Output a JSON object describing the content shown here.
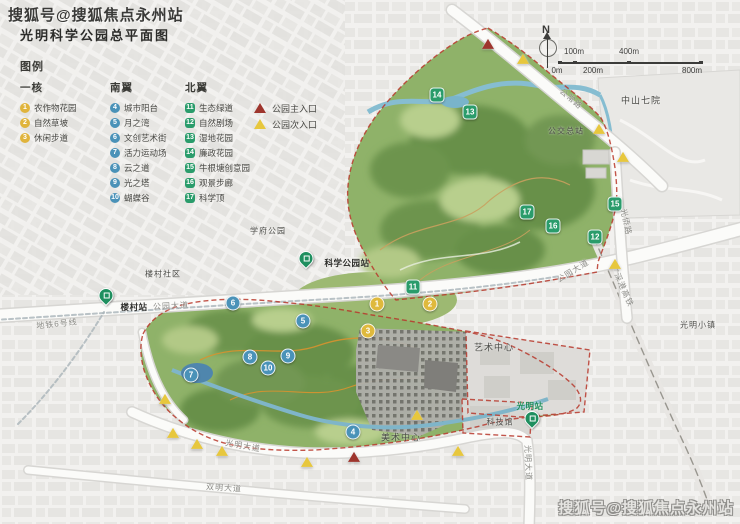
{
  "title": "光明科学公园总平面图",
  "watermarks": {
    "top": "搜狐号@搜狐焦点永州站",
    "bottom": "搜狐号@搜狐焦点永州站"
  },
  "compass": {
    "label": "N"
  },
  "scalebar": {
    "top_labels": [
      {
        "text": "100m",
        "x": 26
      },
      {
        "text": "400m",
        "x": 81
      }
    ],
    "bottom_labels": [
      {
        "text": "0m",
        "x": 9
      },
      {
        "text": "200m",
        "x": 45
      },
      {
        "text": "800m",
        "x": 144
      }
    ]
  },
  "legend": {
    "heading": "图例",
    "groups": [
      {
        "name": "一核",
        "cls": "core",
        "items": [
          {
            "num": "1",
            "label": "农作物花园"
          },
          {
            "num": "2",
            "label": "自然草坡"
          },
          {
            "num": "3",
            "label": "休闲步道"
          }
        ]
      },
      {
        "name": "南翼",
        "cls": "south",
        "items": [
          {
            "num": "4",
            "label": "城市阳台"
          },
          {
            "num": "5",
            "label": "月之湾"
          },
          {
            "num": "6",
            "label": "文创艺术街"
          },
          {
            "num": "7",
            "label": "活力运动场"
          },
          {
            "num": "8",
            "label": "云之道"
          },
          {
            "num": "9",
            "label": "光之塔"
          },
          {
            "num": "10",
            "label": "蝴蝶谷"
          }
        ]
      },
      {
        "name": "北翼",
        "cls": "north",
        "items": [
          {
            "num": "11",
            "label": "生态绿道"
          },
          {
            "num": "12",
            "label": "自然剧场"
          },
          {
            "num": "13",
            "label": "湿地花园"
          },
          {
            "num": "14",
            "label": "廉政花园"
          },
          {
            "num": "15",
            "label": "牛根塘创意园"
          },
          {
            "num": "16",
            "label": "观景步廊"
          },
          {
            "num": "17",
            "label": "科学顶"
          }
        ]
      }
    ],
    "entrances": [
      {
        "type": "main",
        "label": "公园主入口",
        "color": "#9e352d"
      },
      {
        "type": "sec",
        "label": "公园次入口",
        "color": "#e7c73d"
      }
    ]
  },
  "map": {
    "marker_colors": {
      "core": "#dfb93c",
      "south": "#4a92b8",
      "north": "#2a9c6b"
    },
    "labels": [
      {
        "text": "中山七院",
        "x": 641,
        "y": 100,
        "rot": 0,
        "cls": "place"
      },
      {
        "text": "公交总站",
        "x": 566,
        "y": 131,
        "rot": 0,
        "cls": "place sm"
      },
      {
        "text": "公常路",
        "x": 571,
        "y": 99,
        "rot": 40,
        "cls": "road"
      },
      {
        "text": "学府公园",
        "x": 268,
        "y": 231,
        "rot": 0,
        "cls": "place sm"
      },
      {
        "text": "楼村社区",
        "x": 163,
        "y": 274,
        "rot": 0,
        "cls": "place sm"
      },
      {
        "text": "公园大道",
        "x": 171,
        "y": 306,
        "rot": -3,
        "cls": "road"
      },
      {
        "text": "公园大道",
        "x": 573,
        "y": 271,
        "rot": -32,
        "cls": "road"
      },
      {
        "text": "光侨路",
        "x": 626,
        "y": 222,
        "rot": 78,
        "cls": "road"
      },
      {
        "text": "广深港高铁",
        "x": 622,
        "y": 286,
        "rot": 66,
        "cls": "road"
      },
      {
        "text": "地铁6号线",
        "x": 57,
        "y": 324,
        "rot": -6,
        "cls": "road"
      },
      {
        "text": "艺术中心",
        "x": 494,
        "y": 347,
        "rot": 0,
        "cls": "place"
      },
      {
        "text": "科技馆",
        "x": 500,
        "y": 422,
        "rot": 0,
        "cls": "place sm"
      },
      {
        "text": "美术中心",
        "x": 401,
        "y": 437,
        "rot": 0,
        "cls": "place"
      },
      {
        "text": "光明小镇",
        "x": 698,
        "y": 325,
        "rot": 0,
        "cls": "place sm"
      },
      {
        "text": "光明大道",
        "x": 243,
        "y": 446,
        "rot": 10,
        "cls": "road"
      },
      {
        "text": "光明大道",
        "x": 528,
        "y": 463,
        "rot": 88,
        "cls": "road"
      },
      {
        "text": "双明大道",
        "x": 224,
        "y": 488,
        "rot": 4,
        "cls": "road"
      },
      {
        "text": "楼村站",
        "x": 134,
        "y": 307,
        "rot": 0,
        "cls": "station"
      },
      {
        "text": "科学公园站",
        "x": 347,
        "y": 263,
        "rot": 0,
        "cls": "station"
      },
      {
        "text": "光明站",
        "x": 530,
        "y": 406,
        "rot": 0,
        "cls": "station green"
      }
    ],
    "markers": [
      {
        "g": "core",
        "n": "1",
        "x": 377,
        "y": 304
      },
      {
        "g": "core",
        "n": "2",
        "x": 430,
        "y": 304
      },
      {
        "g": "core",
        "n": "3",
        "x": 368,
        "y": 331
      },
      {
        "g": "south",
        "n": "4",
        "x": 353,
        "y": 432
      },
      {
        "g": "south",
        "n": "5",
        "x": 303,
        "y": 321
      },
      {
        "g": "south",
        "n": "6",
        "x": 233,
        "y": 303
      },
      {
        "g": "south",
        "n": "7",
        "x": 191,
        "y": 375
      },
      {
        "g": "south",
        "n": "8",
        "x": 250,
        "y": 357
      },
      {
        "g": "south",
        "n": "9",
        "x": 288,
        "y": 356
      },
      {
        "g": "south",
        "n": "10",
        "x": 268,
        "y": 368
      },
      {
        "g": "north",
        "n": "11",
        "x": 413,
        "y": 287
      },
      {
        "g": "north",
        "n": "12",
        "x": 595,
        "y": 237
      },
      {
        "g": "north",
        "n": "13",
        "x": 470,
        "y": 112
      },
      {
        "g": "north",
        "n": "14",
        "x": 437,
        "y": 95
      },
      {
        "g": "north",
        "n": "15",
        "x": 615,
        "y": 204
      },
      {
        "g": "north",
        "n": "16",
        "x": 553,
        "y": 226
      },
      {
        "g": "north",
        "n": "17",
        "x": 527,
        "y": 212
      }
    ],
    "entrance_points": [
      {
        "t": "main",
        "x": 488,
        "y": 33
      },
      {
        "t": "main",
        "x": 354,
        "y": 446
      },
      {
        "t": "sec",
        "x": 523,
        "y": 48
      },
      {
        "t": "sec",
        "x": 599,
        "y": 118
      },
      {
        "t": "sec",
        "x": 623,
        "y": 146
      },
      {
        "t": "sec",
        "x": 615,
        "y": 253
      },
      {
        "t": "sec",
        "x": 165,
        "y": 388
      },
      {
        "t": "sec",
        "x": 173,
        "y": 422
      },
      {
        "t": "sec",
        "x": 197,
        "y": 433
      },
      {
        "t": "sec",
        "x": 222,
        "y": 440
      },
      {
        "t": "sec",
        "x": 307,
        "y": 451
      },
      {
        "t": "sec",
        "x": 417,
        "y": 404
      },
      {
        "t": "sec",
        "x": 458,
        "y": 440
      }
    ],
    "metro_pins": [
      {
        "x": 106,
        "y": 303
      },
      {
        "x": 306,
        "y": 266
      },
      {
        "x": 532,
        "y": 426
      }
    ]
  }
}
